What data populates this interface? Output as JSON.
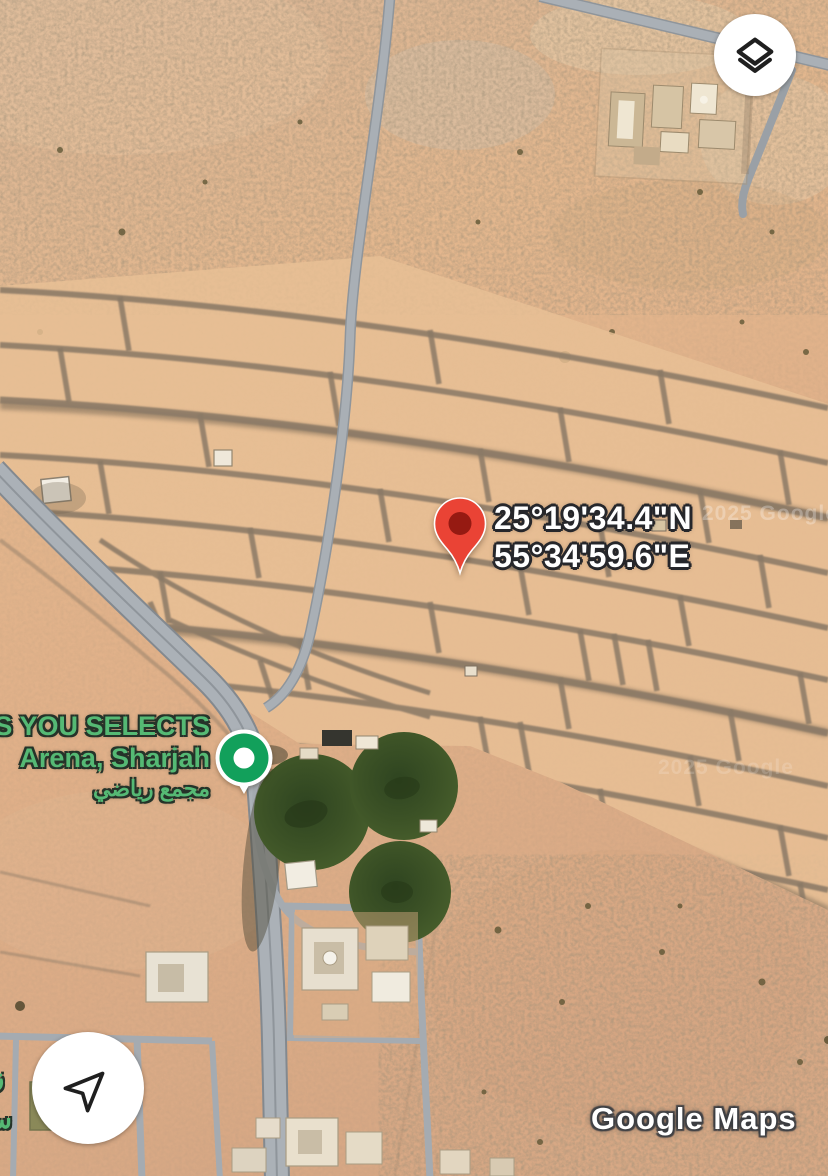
{
  "map": {
    "type": "satellite",
    "watermark": {
      "brand": "Google Maps",
      "copyright": "2025 Google"
    },
    "colors": {
      "sand": "#e2b58c",
      "sand_grid": "#e8bf95",
      "dirt_road": "#8a7966",
      "paved_road": "#abb1b7",
      "field_green": "#3c5226",
      "pin_red": "#EA4335",
      "pin_inner_red": "#961A12",
      "marker_green": "#12A05B",
      "label_green": "#55b974",
      "label_white": "#ffffff"
    }
  },
  "dropped_pin": {
    "coordinates": {
      "line1": "25°19'34.4\"N",
      "line2": "55°34'59.6\"E"
    },
    "marker": "red-map-pin"
  },
  "place": {
    "name_line1": "CS YOU SELECTS",
    "name_line2": "Arena, Sharjah",
    "name_arabic": "مجمع رياضي",
    "marker": "green-place-marker"
  },
  "edge_label_fragments": {
    "line1": "زير",
    "line2": "ساء"
  },
  "controls": {
    "layers": {
      "icon": "layers-icon"
    },
    "my_location": {
      "icon": "navigation-arrow-icon"
    }
  }
}
